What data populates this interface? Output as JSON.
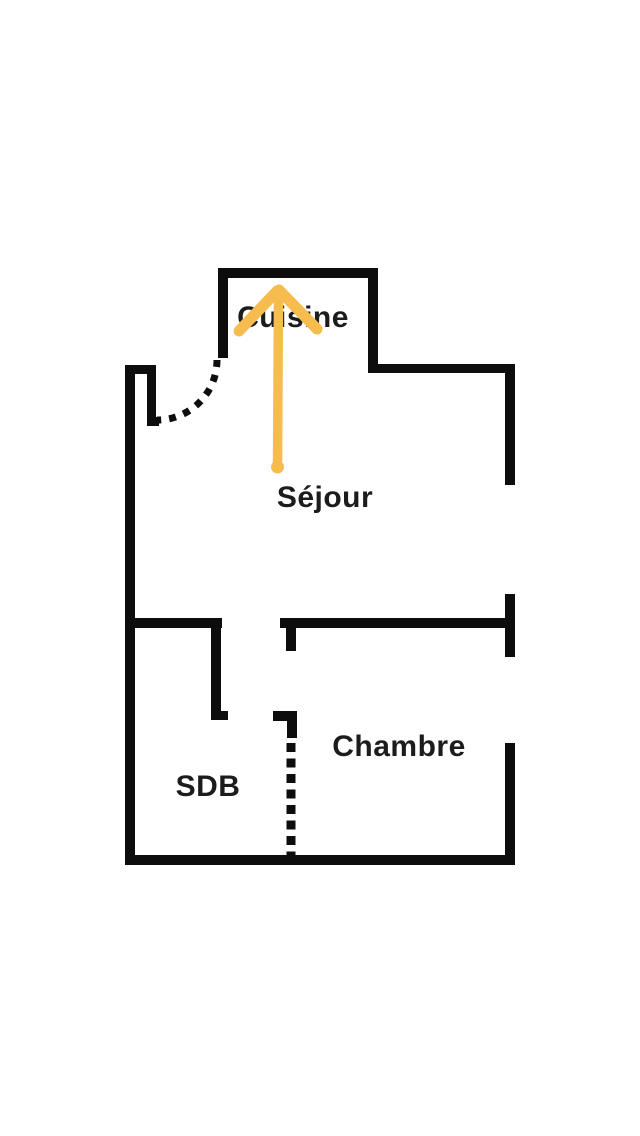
{
  "floor_plan": {
    "title": "apartment-floor-plan",
    "rooms": [
      {
        "id": "cuisine",
        "label": "Cuisine"
      },
      {
        "id": "sejour",
        "label": "Séjour"
      },
      {
        "id": "sdb",
        "label": "SDB"
      },
      {
        "id": "chambre",
        "label": "Chambre"
      }
    ],
    "annotations": [
      {
        "id": "direction-arrow",
        "icon": "arrow-up-icon",
        "color": "#f6bd4e"
      }
    ],
    "features": [
      {
        "id": "door-swing",
        "style": "dashed-arc"
      },
      {
        "id": "sdb-chambre-opening",
        "style": "dashed-line"
      }
    ],
    "colors": {
      "wall": "#0d0d0d",
      "label_text": "#1c1c1e",
      "arrow": "#f6bd4e",
      "background": "#ffffff"
    }
  }
}
